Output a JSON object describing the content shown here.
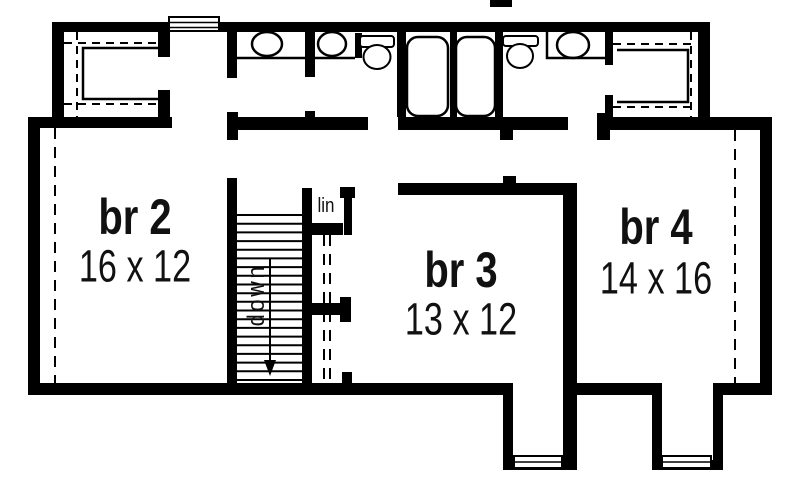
{
  "plan": {
    "type": "floor-plan",
    "rooms": [
      {
        "id": "br2",
        "name": "br 2",
        "size": "16 x 12"
      },
      {
        "id": "br3",
        "name": "br 3",
        "size": "13 x 12"
      },
      {
        "id": "br4",
        "name": "br 4",
        "size": "14 x 16"
      }
    ],
    "stairs": {
      "direction_label": "down"
    },
    "closets": {
      "linen_label": "lin"
    },
    "colors": {
      "ink": "#000000",
      "paper": "#ffffff"
    }
  }
}
